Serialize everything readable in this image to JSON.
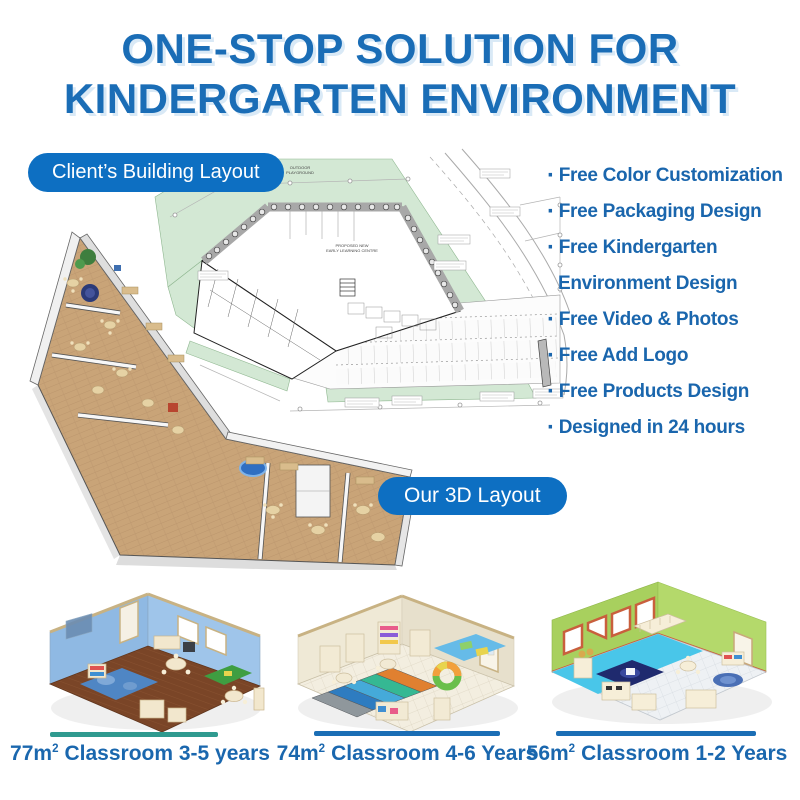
{
  "title": {
    "line1": "ONE-STOP SOLUTION FOR",
    "line2": "KINDERGARTEN ENVIRONMENT"
  },
  "badges": {
    "client_layout": "Client’s Building Layout",
    "our_3d_layout": "Our 3D Layout"
  },
  "features": {
    "bullet": "·",
    "items": [
      {
        "line1": "Free Color Customization"
      },
      {
        "line1": "Free Packaging Design"
      },
      {
        "line1": "Free Kindergarten",
        "line2": "Environment Design"
      },
      {
        "line1": "Free Video & Photos"
      },
      {
        "line1": "Free Add Logo"
      },
      {
        "line1": "Free Products Design"
      },
      {
        "line1": "Designed in 24 hours"
      }
    ]
  },
  "floor_plan": {
    "outdoor_line1": "OUTDOOR",
    "outdoor_line2": "PLAYGROUND",
    "building_line1": "PROPOSED NEW",
    "building_line2": "EARLY LEARNING CENTRE"
  },
  "classrooms": [
    {
      "area": "77m",
      "sup": "2",
      "name": "Classroom 3-5 years",
      "accent": "#2f9a8f"
    },
    {
      "area": "74m",
      "sup": "2",
      "name": "Classroom 4-6 Years",
      "accent": "#1b6eb5"
    },
    {
      "area": "56m",
      "sup": "2",
      "name": "Classroom 1-2 Years",
      "accent": "#1b6eb5"
    }
  ],
  "colors": {
    "title_blue": "#1a6db6",
    "badge_blue": "#0d6fc2",
    "feature_blue": "#1a66ad",
    "divider_teal": "#2f9a8f",
    "divider_blue": "#1b6eb5",
    "plan_green": "#d3e8d4"
  }
}
